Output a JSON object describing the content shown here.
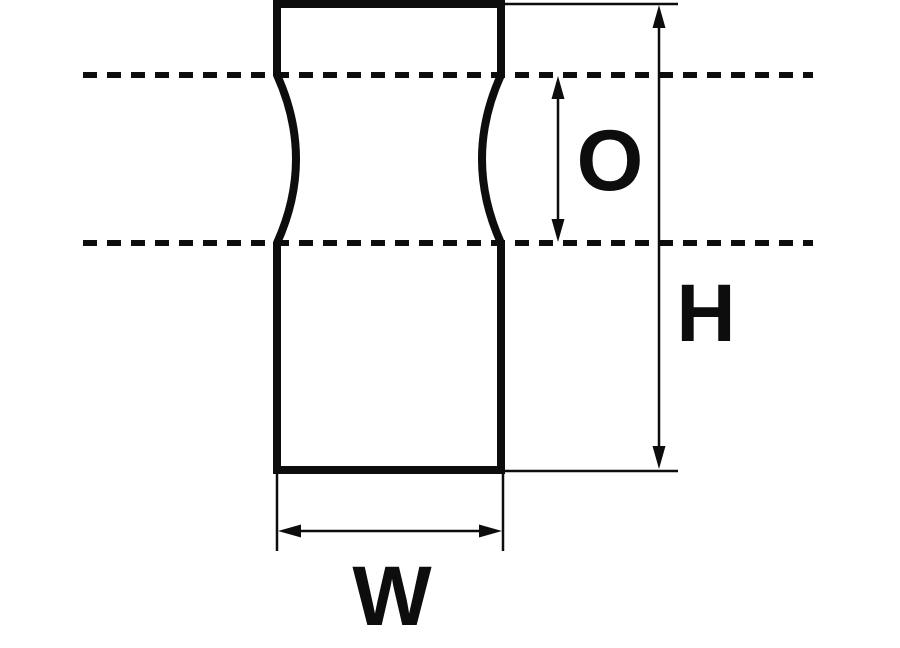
{
  "colors": {
    "background": "#ffffff",
    "line": "#0d0d0d"
  },
  "dimensions": {
    "o": {
      "label": "O"
    },
    "h": {
      "label": "H"
    },
    "w": {
      "label": "W"
    }
  }
}
